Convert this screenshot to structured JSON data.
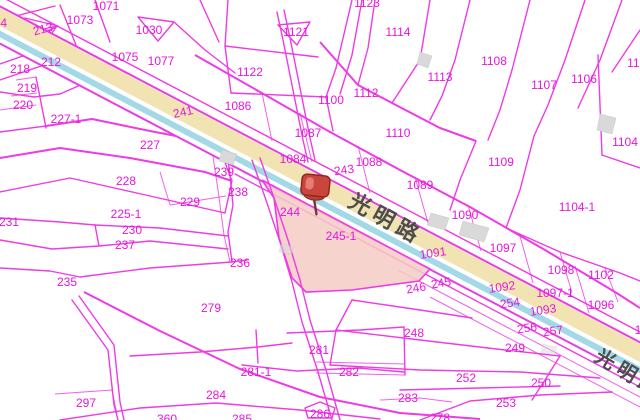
{
  "map": {
    "type": "cadastral-parcel-map",
    "colors": {
      "boundary": "#ee3be4",
      "label": "#e716dc",
      "road_fill": "#f2e3b3",
      "road_stripe": "#a3d9e6",
      "road_text": "#4d4d4d",
      "highlight_fill": "#f6cbc4",
      "building": "#d9d9d9",
      "background": "#ffffff",
      "pin_head": "#c9463e",
      "pin_dark": "#97261e",
      "pin_needle": "#6b3d33",
      "pin_highlight": "#e8837a"
    },
    "road": {
      "name": "光明路"
    },
    "selected_parcel": {
      "id": "245-1"
    },
    "road_labels": [
      {
        "t": "光明路",
        "x": 350,
        "y": 200,
        "r": 29,
        "size": 22
      },
      {
        "t": "光明路",
        "x": 597,
        "y": 354,
        "r": 31,
        "size": 20
      }
    ],
    "labels": [
      {
        "t": "1071",
        "x": 106,
        "y": 6
      },
      {
        "t": "1073",
        "x": 80,
        "y": 20
      },
      {
        "t": "1030",
        "x": 149,
        "y": 30
      },
      {
        "t": "214",
        "x": -3,
        "y": 23
      },
      {
        "t": "213",
        "x": 43,
        "y": 29,
        "r": -15
      },
      {
        "t": "1075",
        "x": 125,
        "y": 57
      },
      {
        "t": "1077",
        "x": 161,
        "y": 61
      },
      {
        "t": "212",
        "x": 51,
        "y": 62
      },
      {
        "t": "218",
        "x": 20,
        "y": 69
      },
      {
        "t": "219",
        "x": 27,
        "y": 88
      },
      {
        "t": "220",
        "x": 23,
        "y": 105
      },
      {
        "t": "227-1",
        "x": 66,
        "y": 119
      },
      {
        "t": "241",
        "x": 183,
        "y": 112,
        "r": -12
      },
      {
        "t": "227",
        "x": 150,
        "y": 145
      },
      {
        "t": "228",
        "x": 126,
        "y": 181
      },
      {
        "t": "229",
        "x": 190,
        "y": 202
      },
      {
        "t": "225-1",
        "x": 126,
        "y": 214
      },
      {
        "t": "231",
        "x": 9,
        "y": 222
      },
      {
        "t": "230",
        "x": 132,
        "y": 230
      },
      {
        "t": "237",
        "x": 125,
        "y": 245
      },
      {
        "t": "239",
        "x": 224,
        "y": 172
      },
      {
        "t": "238",
        "x": 238,
        "y": 192
      },
      {
        "t": "236",
        "x": 240,
        "y": 263
      },
      {
        "t": "235",
        "x": 67,
        "y": 282
      },
      {
        "t": "244",
        "x": 290,
        "y": 212
      },
      {
        "t": "245-1",
        "x": 341,
        "y": 236,
        "size": 13
      },
      {
        "t": "279",
        "x": 211,
        "y": 308
      },
      {
        "t": "297",
        "x": 86,
        "y": 403
      },
      {
        "t": "284",
        "x": 216,
        "y": 395
      },
      {
        "t": "285",
        "x": 242,
        "y": 419
      },
      {
        "t": "360",
        "x": 167,
        "y": 419
      },
      {
        "t": "286",
        "x": 320,
        "y": 414
      },
      {
        "t": "281",
        "x": 319,
        "y": 350
      },
      {
        "t": "281-1",
        "x": 256,
        "y": 372
      },
      {
        "t": "282",
        "x": 349,
        "y": 372
      },
      {
        "t": "283",
        "x": 408,
        "y": 398
      },
      {
        "t": "278",
        "x": 440,
        "y": 418
      },
      {
        "t": "248",
        "x": 414,
        "y": 333
      },
      {
        "t": "252",
        "x": 466,
        "y": 378
      },
      {
        "t": "250",
        "x": 541,
        "y": 383
      },
      {
        "t": "253",
        "x": 506,
        "y": 403
      },
      {
        "t": "249",
        "x": 515,
        "y": 348
      },
      {
        "t": "256",
        "x": 527,
        "y": 328,
        "r": -8
      },
      {
        "t": "257",
        "x": 553,
        "y": 331,
        "r": -8
      },
      {
        "t": "254",
        "x": 510,
        "y": 303,
        "r": -8
      },
      {
        "t": "245",
        "x": 441,
        "y": 283,
        "r": -10
      },
      {
        "t": "246",
        "x": 416,
        "y": 288,
        "r": -10
      },
      {
        "t": "243",
        "x": 344,
        "y": 170,
        "r": -8
      },
      {
        "t": "1092",
        "x": 502,
        "y": 287,
        "r": -8
      },
      {
        "t": "1093",
        "x": 543,
        "y": 310,
        "r": -8
      },
      {
        "t": "1091",
        "x": 433,
        "y": 253,
        "r": -8
      },
      {
        "t": "1084",
        "x": 293,
        "y": 159
      },
      {
        "t": "1086",
        "x": 238,
        "y": 106
      },
      {
        "t": "1087",
        "x": 308,
        "y": 133
      },
      {
        "t": "1088",
        "x": 369,
        "y": 162
      },
      {
        "t": "1089",
        "x": 420,
        "y": 185
      },
      {
        "t": "1090",
        "x": 465,
        "y": 215
      },
      {
        "t": "1097",
        "x": 503,
        "y": 248
      },
      {
        "t": "1109",
        "x": 501,
        "y": 162
      },
      {
        "t": "1104-1",
        "x": 577,
        "y": 207
      },
      {
        "t": "1104",
        "x": 625,
        "y": 142
      },
      {
        "t": "1105",
        "x": 640,
        "y": 63
      },
      {
        "t": "1106",
        "x": 584,
        "y": 79
      },
      {
        "t": "1107",
        "x": 544,
        "y": 85
      },
      {
        "t": "1108",
        "x": 494,
        "y": 61
      },
      {
        "t": "1113",
        "x": 440,
        "y": 77
      },
      {
        "t": "1114",
        "x": 398,
        "y": 32
      },
      {
        "t": "1110",
        "x": 398,
        "y": 133
      },
      {
        "t": "1112",
        "x": 366,
        "y": 93
      },
      {
        "t": "1100",
        "x": 331,
        "y": 100
      },
      {
        "t": "1122",
        "x": 250,
        "y": 72
      },
      {
        "t": "1121",
        "x": 296,
        "y": 32
      },
      {
        "t": "1123",
        "x": 367,
        "y": 3
      },
      {
        "t": "1098",
        "x": 561,
        "y": 270
      },
      {
        "t": "1102",
        "x": 601,
        "y": 275
      },
      {
        "t": "1097-1",
        "x": 555,
        "y": 293
      },
      {
        "t": "1096",
        "x": 601,
        "y": 305
      },
      {
        "t": "1094",
        "x": 648,
        "y": 330
      }
    ]
  }
}
